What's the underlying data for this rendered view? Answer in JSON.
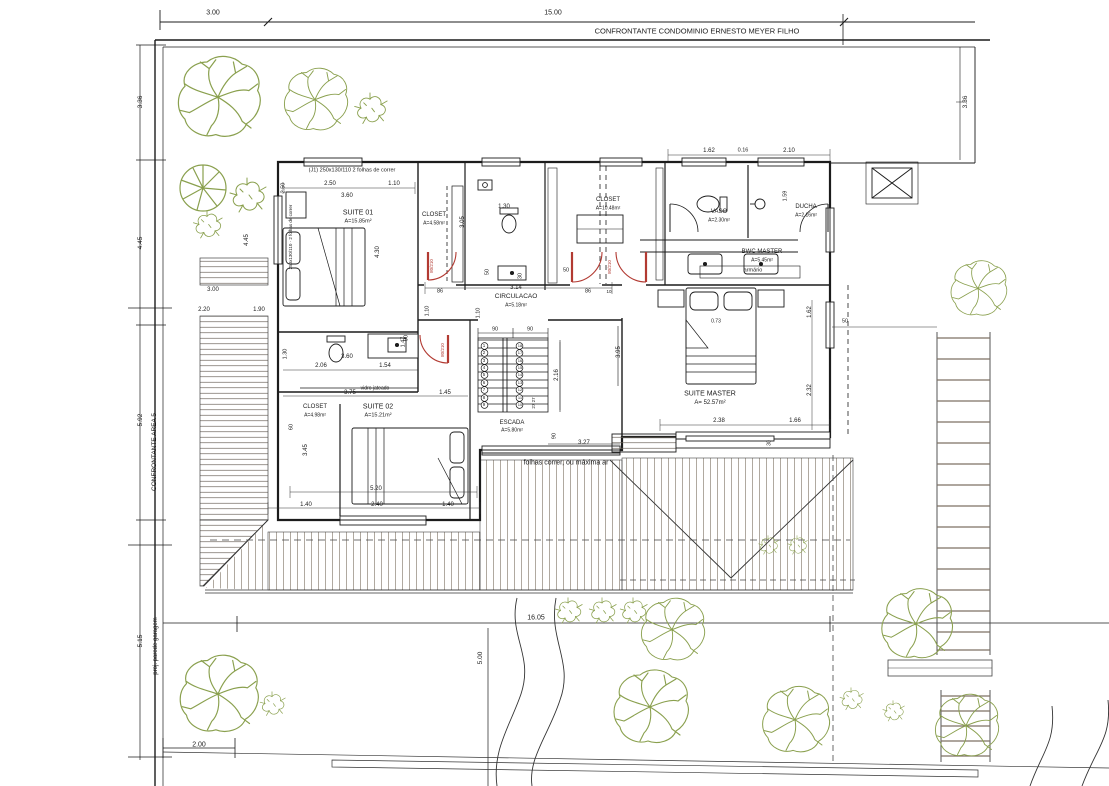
{
  "title": "Planta baixa - pavimento superior",
  "colors": {
    "line": "#1c1c1c",
    "tree": "#8aa04e",
    "door": "#b23a32",
    "hatch": "#8d8478"
  },
  "annotations": {
    "site": [
      {
        "n": "dim-top-3-00",
        "t": "3.00",
        "x": 213,
        "y": 13,
        "s": 7
      },
      {
        "n": "dim-top-15-00",
        "t": "15.00",
        "x": 553,
        "y": 13,
        "s": 7
      },
      {
        "n": "boundary-north-label",
        "t": "CONFRONTANTE CONDOMINIO ERNESTO MEYER FILHO",
        "x": 697,
        "y": 31,
        "s": 7.5
      },
      {
        "n": "dim-right-3-36",
        "t": "3.36",
        "x": 966,
        "y": 102,
        "r": -90,
        "s": 6.5
      },
      {
        "n": "dim-left-3-36",
        "t": "3.36",
        "x": 141,
        "y": 102,
        "r": -90,
        "s": 6.5
      },
      {
        "n": "dim-left-4-45",
        "t": "4.45",
        "x": 141,
        "y": 243,
        "r": -90,
        "s": 6.5
      },
      {
        "n": "dim-left-5-92",
        "t": "5.92",
        "x": 141,
        "y": 420,
        "r": -90,
        "s": 6.5
      },
      {
        "n": "boundary-west-label",
        "t": "CONFRONTANTE AREA 5",
        "x": 155,
        "y": 452,
        "r": -90,
        "s": 6.5
      },
      {
        "n": "dim-left-5-15",
        "t": "5.15",
        "x": 141,
        "y": 641,
        "r": -90,
        "s": 6.5
      },
      {
        "n": "note-garage-wall",
        "t": "proj. parede garagem",
        "x": 156,
        "y": 646,
        "r": -90,
        "s": 6
      },
      {
        "n": "dim-bottom-2-00",
        "t": "2.00",
        "x": 199,
        "y": 745,
        "s": 7
      },
      {
        "n": "dim-16-05",
        "t": "16.05",
        "x": 536,
        "y": 618,
        "s": 7
      },
      {
        "n": "dim-5-00",
        "t": "5.00",
        "x": 481,
        "y": 658,
        "r": -90,
        "s": 6.5
      },
      {
        "n": "dim-garage-3-00",
        "t": "3.00",
        "x": 213,
        "y": 290,
        "s": 6
      },
      {
        "n": "dim-garage-2-20",
        "t": "2.20",
        "x": 204,
        "y": 310,
        "s": 6
      },
      {
        "n": "dim-garage-1-90",
        "t": "1.90",
        "x": 259,
        "y": 310,
        "s": 6
      },
      {
        "n": "dim-garage-4-45",
        "t": "4.45",
        "x": 247,
        "y": 240,
        "r": -90,
        "s": 6
      }
    ],
    "rooms": [
      {
        "n": "room-suite01-title",
        "t": "SUITE 01",
        "x": 358,
        "y": 213,
        "s": 7
      },
      {
        "n": "room-suite01-area",
        "t": "A=15.85m²",
        "x": 358,
        "y": 222,
        "s": 5.5
      },
      {
        "n": "room-closet1-title",
        "t": "CLOSET",
        "x": 434,
        "y": 215,
        "s": 6
      },
      {
        "n": "room-closet1-area",
        "t": "A=4.58m²",
        "x": 434,
        "y": 224,
        "s": 5
      },
      {
        "n": "room-closet-master-title",
        "t": "CLOSET",
        "x": 608,
        "y": 200,
        "s": 6
      },
      {
        "n": "room-closet-master-area",
        "t": "A=10.48m²",
        "x": 608,
        "y": 209,
        "s": 5
      },
      {
        "n": "room-vaso-title",
        "t": "VASO",
        "x": 719,
        "y": 212,
        "s": 6
      },
      {
        "n": "room-vaso-area",
        "t": "A=2.30m²",
        "x": 719,
        "y": 221,
        "s": 5
      },
      {
        "n": "room-ducha-title",
        "t": "DUCHA",
        "x": 806,
        "y": 207,
        "s": 6
      },
      {
        "n": "room-ducha-area",
        "t": "A=2.16m²",
        "x": 806,
        "y": 216,
        "s": 5
      },
      {
        "n": "room-bwc-master-title",
        "t": "BWC MASTER",
        "x": 762,
        "y": 252,
        "s": 6
      },
      {
        "n": "room-bwc-master-area",
        "t": "A=5.45m²",
        "x": 762,
        "y": 261,
        "s": 5
      },
      {
        "n": "room-circulacao-title",
        "t": "CIRCULACAO",
        "x": 516,
        "y": 297,
        "s": 6.5
      },
      {
        "n": "room-circulacao-area",
        "t": "A=5.18m²",
        "x": 516,
        "y": 306,
        "s": 5
      },
      {
        "n": "room-suite-master-title",
        "t": "SUITE MASTER",
        "x": 710,
        "y": 394,
        "s": 7
      },
      {
        "n": "room-suite-master-area",
        "t": "A= 52.57m²",
        "x": 710,
        "y": 403,
        "s": 6
      },
      {
        "n": "room-escada-title",
        "t": "ESCADA",
        "x": 512,
        "y": 423,
        "s": 6
      },
      {
        "n": "room-escada-area",
        "t": "A=5.80m²",
        "x": 512,
        "y": 431,
        "s": 5
      },
      {
        "n": "room-closet2-title",
        "t": "CLOSET",
        "x": 315,
        "y": 407,
        "s": 6
      },
      {
        "n": "room-closet2-area",
        "t": "A=4.98m²",
        "x": 315,
        "y": 416,
        "s": 5
      },
      {
        "n": "room-suite02-title",
        "t": "SUITE 02",
        "x": 378,
        "y": 407,
        "s": 7
      },
      {
        "n": "room-suite02-area",
        "t": "A=15.21m²",
        "x": 378,
        "y": 416,
        "s": 5.5
      }
    ],
    "dims": [
      {
        "n": "dim-s1-2-50",
        "t": "2.50",
        "x": 330,
        "y": 184,
        "s": 6
      },
      {
        "n": "dim-s1-1-10",
        "t": "1.10",
        "x": 394,
        "y": 184,
        "s": 6
      },
      {
        "n": "dim-s1-3-60",
        "t": "3.60",
        "x": 347,
        "y": 196,
        "s": 6
      },
      {
        "n": "dim-s1-2-50b",
        "t": "2.50",
        "x": 284,
        "y": 188,
        "r": -90,
        "s": 5.5
      },
      {
        "n": "dim-closet1-3-05",
        "t": "3.05",
        "x": 463,
        "y": 222,
        "r": -90,
        "s": 6
      },
      {
        "n": "dim-s1-4-30",
        "t": "4.30",
        "x": 378,
        "y": 252,
        "r": -90,
        "s": 6
      },
      {
        "n": "dim-door-90",
        "t": "90",
        "x": 407,
        "y": 338,
        "r": -90,
        "s": 5.5
      },
      {
        "n": "dim-bath1-1-30",
        "t": "1.30",
        "x": 504,
        "y": 207,
        "s": 6
      },
      {
        "n": "dim-bath1-50",
        "t": "50",
        "x": 488,
        "y": 272,
        "r": -90,
        "s": 5.5
      },
      {
        "n": "dim-bath1-30",
        "t": "30",
        "x": 521,
        "y": 276,
        "r": -90,
        "s": 5.5
      },
      {
        "n": "dim-circ-3-14",
        "t": "3.14",
        "x": 516,
        "y": 288,
        "s": 6
      },
      {
        "n": "dim-circ-86a",
        "t": "86",
        "x": 440,
        "y": 292,
        "s": 5.5
      },
      {
        "n": "dim-circ-86b",
        "t": "86",
        "x": 588,
        "y": 292,
        "s": 5.5
      },
      {
        "n": "dim-circ-10",
        "t": "10",
        "x": 609,
        "y": 292,
        "s": 4.5
      },
      {
        "n": "dim-circ-1-10a",
        "t": "1.10",
        "x": 428,
        "y": 311,
        "r": -90,
        "s": 5.5
      },
      {
        "n": "dim-circ-1-10b",
        "t": "1.10",
        "x": 479,
        "y": 313,
        "r": -90,
        "s": 5.5
      },
      {
        "n": "dim-circ-50",
        "t": "50",
        "x": 566,
        "y": 271,
        "s": 5.5
      },
      {
        "n": "dim-bwc-1-62",
        "t": "1.62",
        "x": 709,
        "y": 151,
        "s": 6
      },
      {
        "n": "dim-bwc-0-16",
        "t": "0.16",
        "x": 743,
        "y": 151,
        "s": 5.5
      },
      {
        "n": "dim-bwc-2-10",
        "t": "2.10",
        "x": 789,
        "y": 151,
        "s": 6
      },
      {
        "n": "dim-bwc-1-59",
        "t": "1.59",
        "x": 786,
        "y": 196,
        "r": -90,
        "s": 5.5
      },
      {
        "n": "dim-sm-1-62",
        "t": "1.62",
        "x": 810,
        "y": 312,
        "r": -90,
        "s": 6
      },
      {
        "n": "dim-sm-2-32",
        "t": "2.32",
        "x": 810,
        "y": 390,
        "r": -90,
        "s": 6
      },
      {
        "n": "dim-sm-50",
        "t": "50",
        "x": 845,
        "y": 322,
        "s": 5.5
      },
      {
        "n": "dim-sm-2-38",
        "t": "2.38",
        "x": 719,
        "y": 421,
        "s": 6
      },
      {
        "n": "dim-sm-1-66",
        "t": "1.66",
        "x": 795,
        "y": 421,
        "s": 6
      },
      {
        "n": "dim-sm-30",
        "t": "30",
        "x": 770,
        "y": 443,
        "r": -90,
        "s": 5
      },
      {
        "n": "dim-sm-0-73",
        "t": "0.73",
        "x": 716,
        "y": 322,
        "s": 5
      },
      {
        "n": "dim-esc-90a",
        "t": "90",
        "x": 495,
        "y": 330,
        "s": 5.5
      },
      {
        "n": "dim-esc-90b",
        "t": "90",
        "x": 530,
        "y": 330,
        "s": 5.5
      },
      {
        "n": "dim-esc-2-16",
        "t": "2.16",
        "x": 557,
        "y": 375,
        "r": -90,
        "s": 6
      },
      {
        "n": "dim-esc-90c",
        "t": "90",
        "x": 555,
        "y": 436,
        "r": -90,
        "s": 5.5
      },
      {
        "n": "dim-esc-3-27",
        "t": "3.27",
        "x": 584,
        "y": 443,
        "s": 6
      },
      {
        "n": "dim-esc-3-95",
        "t": "3.95",
        "x": 619,
        "y": 352,
        "r": -90,
        "s": 6
      },
      {
        "n": "dim-esc-27-27",
        "t": "27 27",
        "x": 534,
        "y": 403,
        "r": -90,
        "s": 4.5
      },
      {
        "n": "dim-bath2-1-30",
        "t": "1.30",
        "x": 286,
        "y": 354,
        "r": -90,
        "s": 5.5
      },
      {
        "n": "dim-bath2-2-06",
        "t": "2.06",
        "x": 321,
        "y": 366,
        "s": 6
      },
      {
        "n": "dim-bath2-3-60",
        "t": "3.60",
        "x": 347,
        "y": 357,
        "s": 6
      },
      {
        "n": "dim-bath2-1-54",
        "t": "1.54",
        "x": 385,
        "y": 366,
        "s": 6
      },
      {
        "n": "dim-bath2-1-47",
        "t": "1.47",
        "x": 404,
        "y": 342,
        "r": -90,
        "s": 5.5
      },
      {
        "n": "dim-s2-3-75",
        "t": "3.75",
        "x": 350,
        "y": 393,
        "s": 6
      },
      {
        "n": "dim-s2-1-45",
        "t": "1.45",
        "x": 445,
        "y": 393,
        "s": 6
      },
      {
        "n": "dim-s2-60",
        "t": "60",
        "x": 292,
        "y": 427,
        "r": -90,
        "s": 5.5
      },
      {
        "n": "dim-s2-3-45",
        "t": "3.45",
        "x": 306,
        "y": 450,
        "r": -90,
        "s": 6
      },
      {
        "n": "dim-s2-5-20",
        "t": "5.20",
        "x": 376,
        "y": 489,
        "s": 6
      },
      {
        "n": "dim-s2-1-40a",
        "t": "1.40",
        "x": 306,
        "y": 505,
        "s": 6
      },
      {
        "n": "dim-s2-2-40",
        "t": "2.40",
        "x": 377,
        "y": 505,
        "s": 6
      },
      {
        "n": "dim-s2-1-40b",
        "t": "1.40",
        "x": 448,
        "y": 505,
        "s": 6
      }
    ],
    "notes": [
      {
        "n": "note-window-j1",
        "t": "(J1) 250x130/110   2 folhas de correr",
        "x": 352,
        "y": 171,
        "s": 5.5
      },
      {
        "n": "note-window-j1-vert",
        "t": "250x130/110 · 2 folhas de correr",
        "x": 291,
        "y": 237,
        "r": -90,
        "s": 4.5
      },
      {
        "n": "note-vidro-jateado",
        "t": "vidro jateado",
        "x": 375,
        "y": 389,
        "s": 5
      },
      {
        "n": "note-armario",
        "t": "armário",
        "x": 753,
        "y": 271,
        "s": 5.5
      },
      {
        "n": "note-folhas-correr",
        "t": "folhas correr, ou máxima ar",
        "x": 566,
        "y": 463,
        "s": 7
      },
      {
        "n": "door-label-80-210-a",
        "t": "80/210",
        "x": 432,
        "y": 266,
        "r": -90,
        "s": 4.5,
        "c": "red"
      },
      {
        "n": "door-label-80-210-b",
        "t": "80/210",
        "x": 443,
        "y": 350,
        "r": -90,
        "s": 4.5,
        "c": "red"
      },
      {
        "n": "door-label-80-210-c",
        "t": "80/210",
        "x": 610,
        "y": 267,
        "r": -90,
        "s": 4.5,
        "c": "red"
      }
    ],
    "stairSteps": [
      {
        "n": "stair-step-1",
        "t": "1",
        "x": 484,
        "y": 346,
        "s": 4.5
      },
      {
        "n": "stair-step-2",
        "t": "2",
        "x": 484,
        "y": 353,
        "s": 4.5
      },
      {
        "n": "stair-step-3",
        "t": "3",
        "x": 484,
        "y": 361,
        "s": 4.5
      },
      {
        "n": "stair-step-4",
        "t": "4",
        "x": 484,
        "y": 368,
        "s": 4.5
      },
      {
        "n": "stair-step-5",
        "t": "5",
        "x": 484,
        "y": 375,
        "s": 4.5
      },
      {
        "n": "stair-step-6",
        "t": "6",
        "x": 484,
        "y": 383,
        "s": 4.5
      },
      {
        "n": "stair-step-7",
        "t": "7",
        "x": 484,
        "y": 390,
        "s": 4.5
      },
      {
        "n": "stair-step-8",
        "t": "8",
        "x": 484,
        "y": 398,
        "s": 4.5
      },
      {
        "n": "stair-step-9",
        "t": "9",
        "x": 484,
        "y": 405,
        "s": 4.5
      },
      {
        "n": "stair-step-18",
        "t": "18",
        "x": 520,
        "y": 346,
        "s": 4
      },
      {
        "n": "stair-step-17",
        "t": "17",
        "x": 520,
        "y": 353,
        "s": 4
      },
      {
        "n": "stair-step-16",
        "t": "16",
        "x": 520,
        "y": 361,
        "s": 4
      },
      {
        "n": "stair-step-15",
        "t": "15",
        "x": 520,
        "y": 368,
        "s": 4
      },
      {
        "n": "stair-step-14",
        "t": "14",
        "x": 520,
        "y": 375,
        "s": 4
      },
      {
        "n": "stair-step-13",
        "t": "13",
        "x": 520,
        "y": 383,
        "s": 4
      },
      {
        "n": "stair-step-12",
        "t": "12",
        "x": 520,
        "y": 390,
        "s": 4
      },
      {
        "n": "stair-step-11",
        "t": "11",
        "x": 520,
        "y": 398,
        "s": 4
      },
      {
        "n": "stair-step-10",
        "t": "10",
        "x": 520,
        "y": 405,
        "s": 4
      }
    ]
  }
}
